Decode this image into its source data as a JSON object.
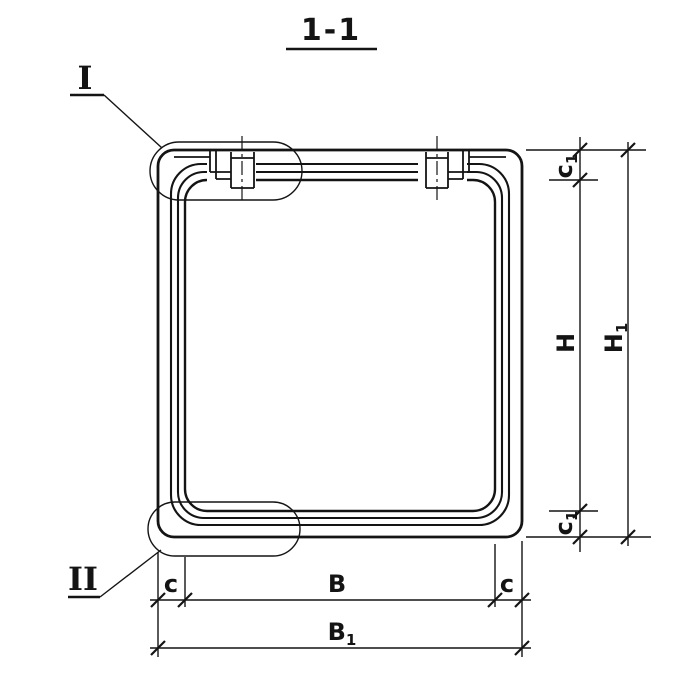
{
  "title": "1-1",
  "callouts": {
    "top": "I",
    "bottom": "II"
  },
  "dims": {
    "c1_top": {
      "base": "c",
      "sub": "1"
    },
    "H": {
      "base": "H",
      "sub": ""
    },
    "c1_bottom": {
      "base": "c",
      "sub": "1"
    },
    "H1": {
      "base": "H",
      "sub": "1"
    },
    "c_left": {
      "base": "c",
      "sub": ""
    },
    "B": {
      "base": "B",
      "sub": ""
    },
    "c_right": {
      "base": "c",
      "sub": ""
    },
    "B1": {
      "base": "B",
      "sub": "1"
    }
  },
  "colors": {
    "ink": "#141414",
    "paper": "#ffffff"
  }
}
